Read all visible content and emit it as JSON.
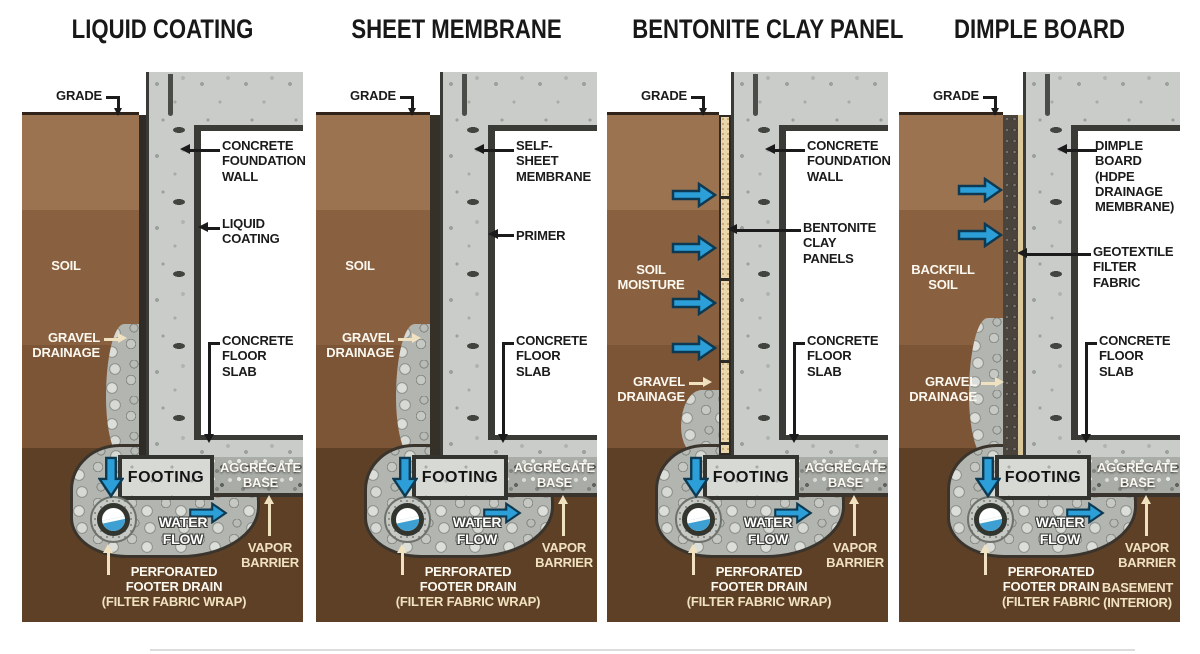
{
  "colors": {
    "soil_top": "#9c7350",
    "soil_mid": "#8a6140",
    "soil_deep": "#7b5536",
    "soil_dark": "#5e4026",
    "concrete": "#c9ccc8",
    "outline_dark": "#3a3b36",
    "water_blue": "#2d9fd8",
    "bentonite_tan": "#ead6aa",
    "cream_label": "#f0e2c0"
  },
  "panels": [
    {
      "title": "LIQUID COATING",
      "labels": {
        "grade": "GRADE",
        "layer1": "CONCRETE\nFOUNDATION\nWALL",
        "layer2": "LIQUID\nCOATING",
        "soil": "SOIL",
        "gravel": "GRAVEL\nDRAINAGE",
        "slab": "CONCRETE\nFLOOR SLAB",
        "footing": "FOOTING",
        "aggregate": "AGGREGATE\nBASE",
        "water_flow": "WATER FLOW",
        "vapor": "VAPOR\nBARRIER",
        "drain": "PERFORATED\nFOOTER DRAIN",
        "drain_sub": "(FILTER FABRIC WRAP)"
      }
    },
    {
      "title": "SHEET MEMBRANE",
      "labels": {
        "grade": "GRADE",
        "layer1": "SELF-\nSHEET\nMEMBRANE",
        "layer2": "PRIMER",
        "soil": "SOIL",
        "gravel": "GRAVEL\nDRAINAGE",
        "slab": "CONCRETE\nFLOOR SLAB",
        "footing": "FOOTING",
        "aggregate": "AGGREGATE\nBASE",
        "water_flow": "WATER FLOW",
        "vapor": "VAPOR\nBARRIER",
        "drain": "PERFORATED\nFOOTER DRAIN",
        "drain_sub": "(FILTER FABRIC WRAP)"
      }
    },
    {
      "title": "BENTONITE CLAY PANEL",
      "labels": {
        "grade": "GRADE",
        "layer1": "CONCRETE\nFOUNDATION\nWALL",
        "layer2": "BENTONITE\nCLAY PANELS",
        "soil": "SOIL\nMOISTURE",
        "gravel": "GRAVEL\nDRAINAGE",
        "slab": "CONCRETE\nFLOOR SLAB",
        "footing": "FOOTING",
        "aggregate": "AGGREGATE\nBASE",
        "water_flow": "WATER FLOW",
        "vapor": "VAPOR\nBARRIER",
        "drain": "PERFORATED\nFOOTER DRAIN",
        "drain_sub": "(FILTER FABRIC WRAP)"
      }
    },
    {
      "title": "DIMPLE BOARD",
      "labels": {
        "grade": "GRADE",
        "layer1": "DIMPLE\nBOARD (HDPE\nDRAINAGE\nMEMBRANE)",
        "layer2": "GEOTEXTILE\nFILTER FABRIC",
        "soil": "BACKFILL\nSOIL",
        "gravel": "GRAVEL\nDRAINAGE",
        "slab": "CONCRETE\nFLOOR SLAB",
        "footing": "FOOTING",
        "aggregate": "AGGREGATE\nBASE",
        "water_flow": "WATER FLOW",
        "vapor": "VAPOR\nBARRIER",
        "drain": "PERFORATED\nFOOTER DRAIN",
        "drain_sub": "(FILTER FABRIC",
        "basement": "BASEMENT\n(INTERIOR)"
      }
    }
  ]
}
